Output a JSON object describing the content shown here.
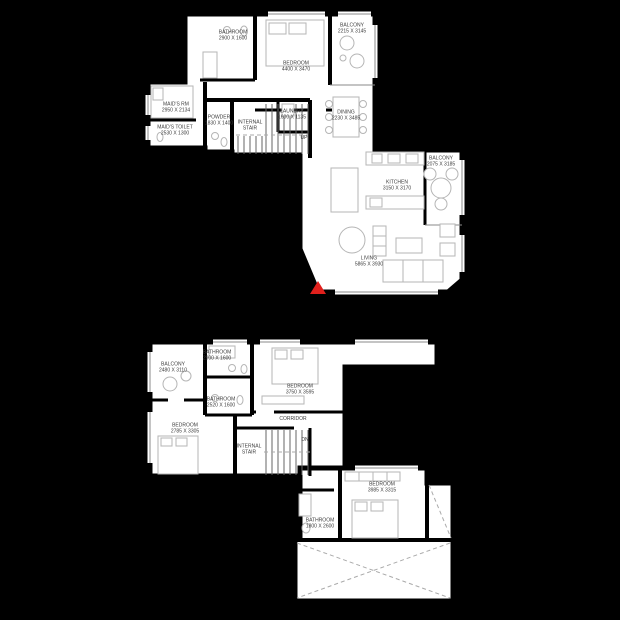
{
  "colors": {
    "background": "#000000",
    "floor": "#ffffff",
    "wall": "#000000",
    "entry_marker": "#e0201c",
    "label_text": "#3c3c3c"
  },
  "floors": [
    {
      "id": "upper-level",
      "stair_direction": "UP",
      "rooms": [
        {
          "name": "BATHROOM",
          "dims": "2900 X 1600"
        },
        {
          "name": "BEDROOM",
          "dims": "4400 X 3470"
        },
        {
          "name": "BALCONY",
          "dims": "2215 X 3145"
        },
        {
          "name": "MAID'S RM",
          "dims": "2950 X 2134"
        },
        {
          "name": "MAID'S TOILET",
          "dims": "2530 X 1300"
        },
        {
          "name": "POWDER",
          "dims": "1830 X 1400"
        },
        {
          "name": "INTERNAL STAIR",
          "dims": ""
        },
        {
          "name": "LAUNDRY",
          "dims": "1600 X 1135"
        },
        {
          "name": "DINING",
          "dims": "2230 X 3485"
        },
        {
          "name": "KITCHEN",
          "dims": "3150 X 3170"
        },
        {
          "name": "BALCONY",
          "dims": "2075 X 3185"
        },
        {
          "name": "LIVING",
          "dims": "5865 X 3930"
        }
      ]
    },
    {
      "id": "lower-level",
      "stair_direction": "DN",
      "rooms": [
        {
          "name": "BALCONY",
          "dims": "2480 X 3110"
        },
        {
          "name": "BATHROOM",
          "dims": "2900 X 1600"
        },
        {
          "name": "BEDROOM",
          "dims": "3750 X 3595"
        },
        {
          "name": "BATHROOM",
          "dims": "2520 X 1600"
        },
        {
          "name": "BEDROOM",
          "dims": "2785 X 3305"
        },
        {
          "name": "CORRIDOR",
          "dims": ""
        },
        {
          "name": "INTERNAL STAIR",
          "dims": ""
        },
        {
          "name": "BEDROOM",
          "dims": "3985 X 3315"
        },
        {
          "name": "BATHROOM",
          "dims": "1800 X 2600"
        }
      ]
    }
  ]
}
